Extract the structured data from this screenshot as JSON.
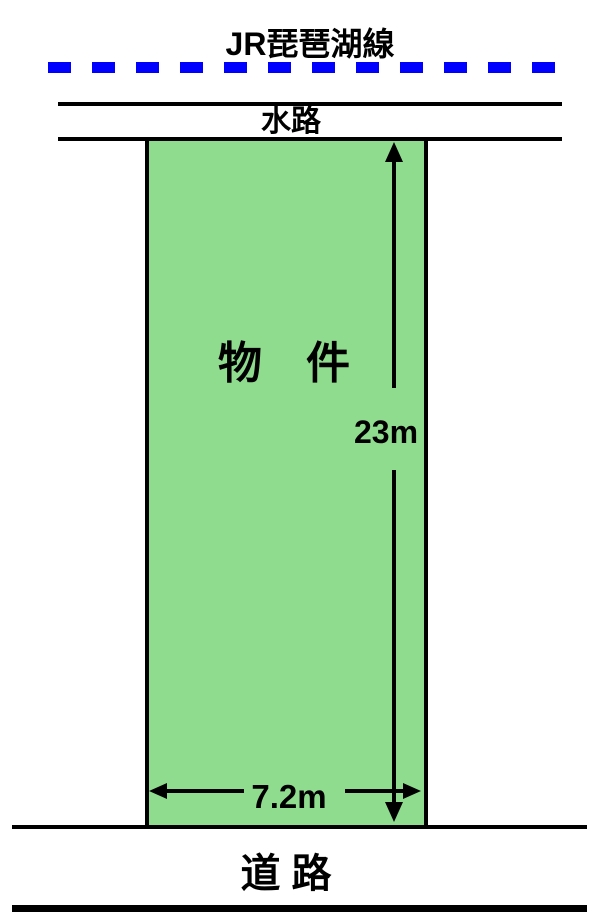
{
  "railway": {
    "label": "JR琵琶湖線"
  },
  "waterway": {
    "label": "水路"
  },
  "parcel": {
    "label": "物　件"
  },
  "dimensions": {
    "depth": "23m",
    "frontage": "7.2m"
  },
  "road": {
    "label": "道 路"
  },
  "colors": {
    "railway_blue": "#0000FF",
    "parcel_fill": "#8FDC8F",
    "line_black": "#000000",
    "background": "#FFFFFF"
  }
}
